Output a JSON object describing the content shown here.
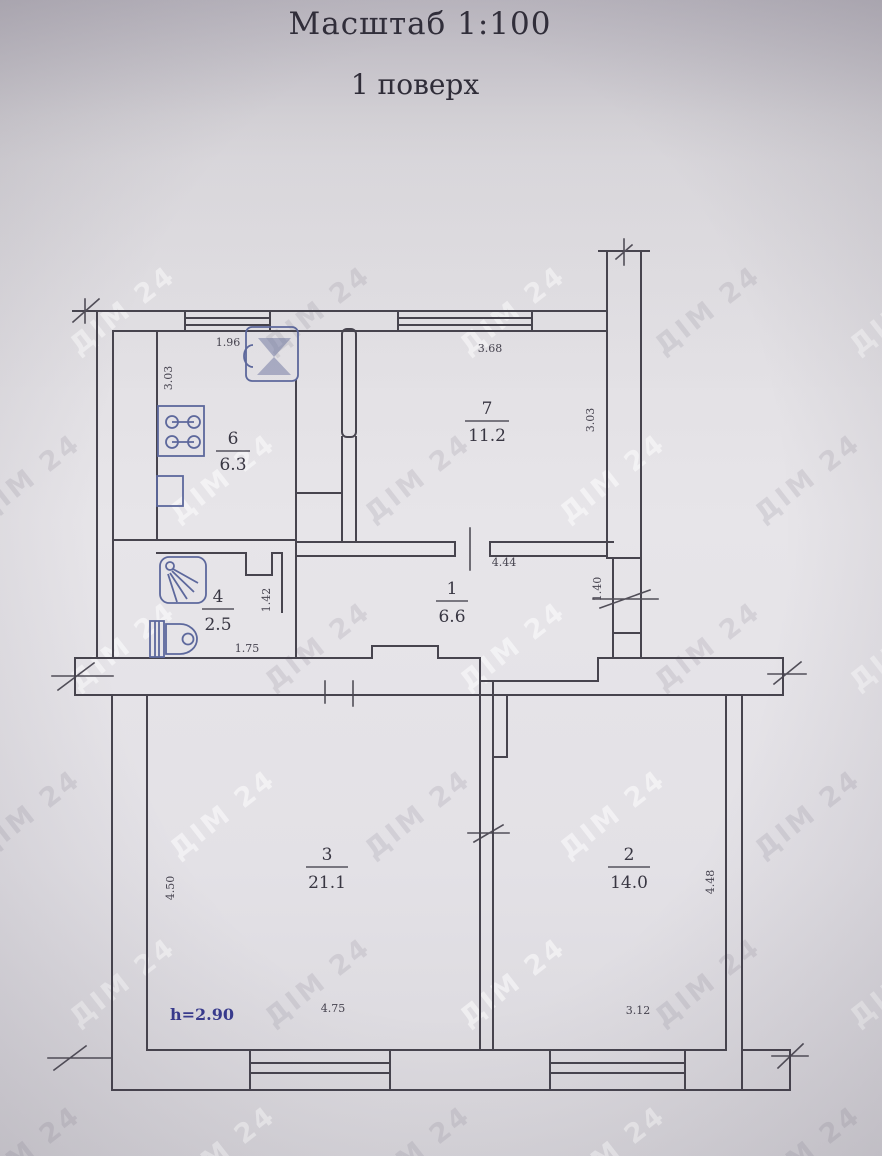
{
  "title": "Масштаб 1:100",
  "subtitle": "1 поверх",
  "watermark": {
    "text": "ДІМ 24"
  },
  "plan": {
    "height_note": "h=2.90",
    "rooms": [
      {
        "id": "room-7",
        "number": "7",
        "area": "11.2",
        "dims": {
          "top": "3.68",
          "right": "3.03"
        }
      },
      {
        "id": "room-6",
        "number": "6",
        "area": "6.3",
        "dims": {
          "top": "1.96",
          "left": "3.03"
        }
      },
      {
        "id": "room-1",
        "number": "1",
        "area": "6.6",
        "dims": {
          "top": "4.44",
          "right": "1.40"
        }
      },
      {
        "id": "room-4",
        "number": "4",
        "area": "2.5",
        "dims": {
          "bottom": "1.75",
          "right": "1.42"
        }
      },
      {
        "id": "room-3",
        "number": "3",
        "area": "21.1",
        "dims": {
          "left": "4.50",
          "bottom": "4.75"
        }
      },
      {
        "id": "room-2",
        "number": "2",
        "area": "14.0",
        "dims": {
          "right": "4.48",
          "bottom": "3.12"
        }
      }
    ],
    "fixtures": [
      "stove-icon",
      "sink-icon",
      "shower-icon",
      "toilet-icon"
    ],
    "colors": {
      "wall": "#47444e",
      "fixture": "#5d689c",
      "text": "#383642",
      "note_ink": "#383b8f",
      "paper": "#e3e1e6"
    }
  }
}
